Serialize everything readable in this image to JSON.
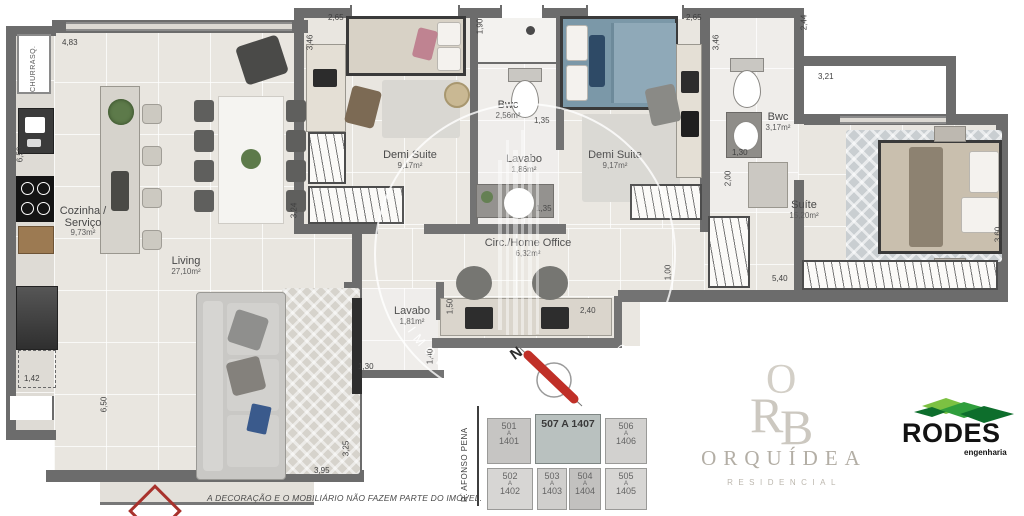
{
  "rooms": {
    "cozinha": {
      "name": "Cozinha / Serviço",
      "area": "9,73m²"
    },
    "living": {
      "name": "Living",
      "area": "27,10m²"
    },
    "demi1": {
      "name": "Demi Suite",
      "area": "9,17m²"
    },
    "bwc1": {
      "name": "Bwc",
      "area": "2,56m²"
    },
    "lavabo1": {
      "name": "Lavabo",
      "area": "1,86m²"
    },
    "demi2": {
      "name": "Demi Suite",
      "area": "9,17m²"
    },
    "bwc2": {
      "name": "Bwc",
      "area": "3,17m²"
    },
    "suite": {
      "name": "Suíte",
      "area": "15,20m²"
    },
    "circ": {
      "name": "Circ./Home Office",
      "area": "6,32m²"
    },
    "lavabo2": {
      "name": "Lavabo",
      "area": "1,81m²"
    },
    "churrasqueira": {
      "name": "CHURRASQ."
    }
  },
  "dims": {
    "d483": "4,83",
    "d650a": "6,50",
    "d142": "1,42",
    "d650b": "6,50",
    "d324": "3,24",
    "d265a": "2,65",
    "d346a": "3,46",
    "d190": "1,90",
    "d135a": "1,35",
    "d135b": "1,35",
    "d265b": "2,65",
    "d346b": "3,46",
    "d244": "2,44",
    "d130a": "1,30",
    "d200": "2,00",
    "d321": "3,21",
    "d360": "3,60",
    "d540": "5,40",
    "d100": "1,00",
    "d150": "1,50",
    "d240": "2,40",
    "d130b": "1,30",
    "d140": "1,40",
    "d395": "3,95",
    "d325": "3,25"
  },
  "compass": {
    "label": "N"
  },
  "watermark": {
    "text": "IMOBILIARIA DRUMOND"
  },
  "disclaimer": "A  DECORAÇÃO E O MOBILIÁRIO NÃO FAZEM PARTE DO IMÓVEL.",
  "keyplan": {
    "street": "R. AFONSO PENA",
    "highlight": "507 A 1407",
    "units": [
      {
        "n1": "501",
        "a": "A",
        "n2": "1401"
      },
      {
        "n1": "506",
        "a": "A",
        "n2": "1406"
      },
      {
        "n1": "502",
        "a": "A",
        "n2": "1402"
      },
      {
        "n1": "503",
        "a": "A",
        "n2": "1403"
      },
      {
        "n1": "504",
        "a": "A",
        "n2": "1404"
      },
      {
        "n1": "505",
        "a": "A",
        "n2": "1405"
      }
    ]
  },
  "logos": {
    "orquidea": {
      "mono_o": "O",
      "mono_r": "R",
      "mono_b": "B",
      "name": "ORQUÍDEA",
      "tagline": "RESIDENCIAL"
    },
    "rodes": {
      "name": "RODES",
      "tagline": "engenharia",
      "green_dark": "#0d6e2c",
      "green_mid": "#2f9e3c",
      "green_light": "#7cc142"
    }
  },
  "colors": {
    "wall": "#6c6c6c",
    "floor": "#e9e6e0",
    "accent_red": "#c03028"
  }
}
